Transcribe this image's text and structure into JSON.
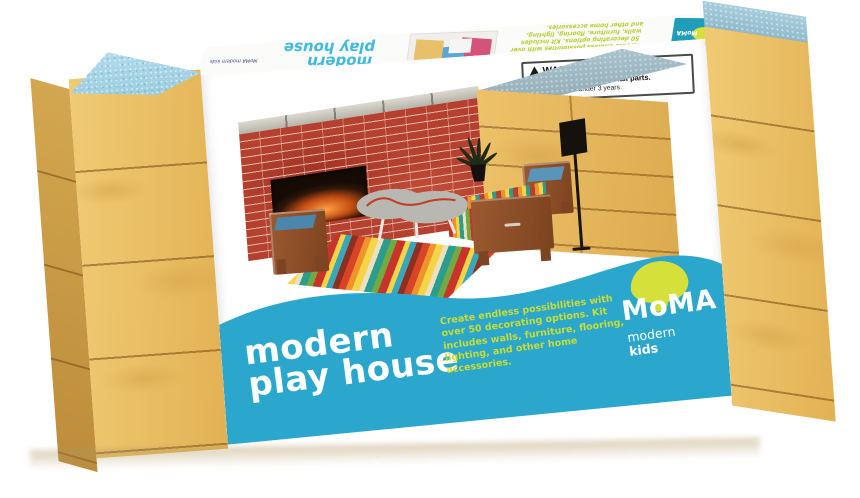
{
  "front": {
    "warning": {
      "title": "WARNING:",
      "hazard": "CHOKING HAZARD",
      "hazard_rest": "—Small parts.",
      "note": "Not for children under 3 years."
    },
    "title_line1": "modern",
    "title_line2": "play house",
    "description": "Create endless possibilities with over 50 decorating options. Kit includes walls, furniture, flooring, lighting, and other home accessories.",
    "brand": {
      "name": "MoMA",
      "sub1": "modern",
      "sub2": "kids"
    }
  },
  "top_flap": {
    "title": "modern play house",
    "fine_print": "MoMA modern kids",
    "description": "Create endless possibilities with over 50 decorating options. Kit includes walls, furniture, flooring, lighting, and other home accessories.",
    "logo": "MoMA"
  },
  "colors": {
    "band_blue": "#2BA7CE",
    "accent_green": "#C9DC2F",
    "logo_blob": "#D6E03B",
    "wood": "#ECC26C",
    "block_top_blue": "#A9D6E8",
    "cabinet_top_gray": "#A4BFCA",
    "brick_red": "#B5402F"
  }
}
